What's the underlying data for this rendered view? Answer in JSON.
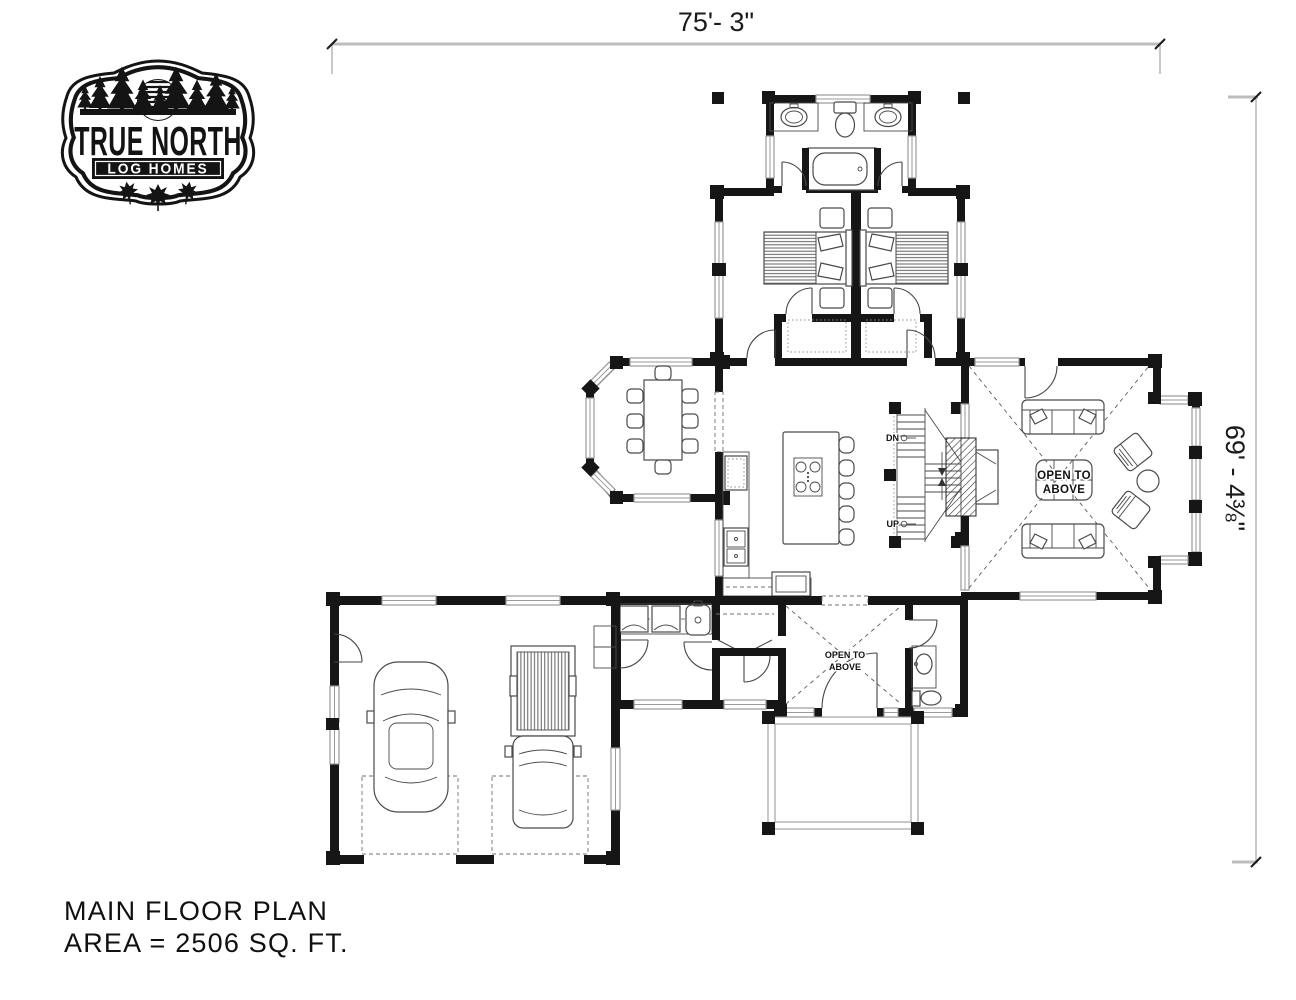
{
  "logo": {
    "line1": "TRUE NORTH",
    "line2": "LOG HOMES"
  },
  "dimensions": {
    "top": "75'- 3\"",
    "right": "69' - 4⅜\""
  },
  "plan_labels": {
    "stairs_down": "DN",
    "stairs_up": "UP",
    "open_to_line1": "OPEN TO",
    "open_to_line2": "ABOVE"
  },
  "title_block": {
    "line1": "MAIN FLOOR PLAN",
    "line2": "AREA = 2506 SQ. FT."
  },
  "colors": {
    "paper": "#ffffff",
    "wall": "#161616",
    "window_line": "#9a9a9a",
    "furniture_line": "#4a4a4a",
    "dimension_line": "#bdbdbd"
  }
}
